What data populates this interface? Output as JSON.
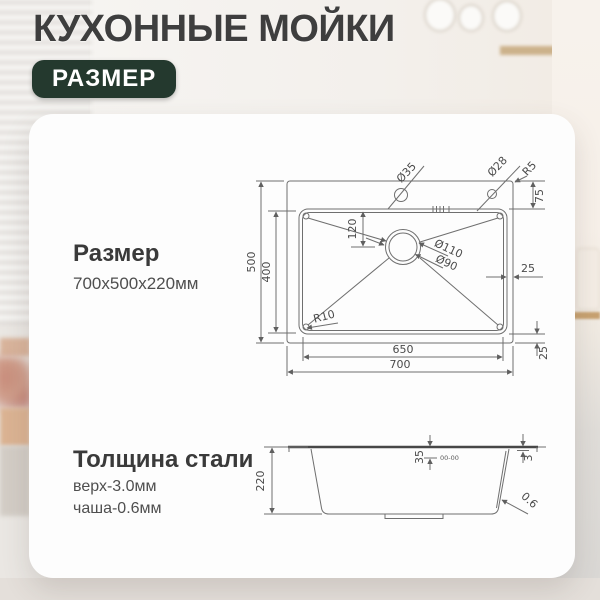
{
  "header": {
    "title": "КУХОННЫЕ МОЙКИ",
    "badge": "РАЗМЕР"
  },
  "size": {
    "title": "Размер",
    "value": "700x500x220мм"
  },
  "thickness": {
    "title": "Толщина стали",
    "top": "верх-3.0мм",
    "bowl": "чаша-0.6мм"
  },
  "top_view": {
    "outer_height": "500",
    "bowl_height": "400",
    "bowl_width": "650",
    "outer_width": "700",
    "drain_offset": "120",
    "deck_depth": "75",
    "rim_right": "25",
    "rim_bottom": "25",
    "hole_large": "Ø35",
    "hole_small": "Ø28",
    "deck_corner_radius": "R5",
    "bowl_corner_radius": "R10",
    "drain_outer": "Ø110",
    "drain_inner": "Ø90"
  },
  "side_view": {
    "depth": "220",
    "ledge": "35",
    "rim_thickness": "3",
    "wall_thickness": "0.6",
    "weld_mark": "00-00"
  },
  "colors": {
    "badge_bg": "#24392e",
    "title_text": "#3e3e3e",
    "card_bg": "#fdfdfd",
    "drawing_line": "#6f6f6f",
    "wood_accent": "#c8a271"
  }
}
